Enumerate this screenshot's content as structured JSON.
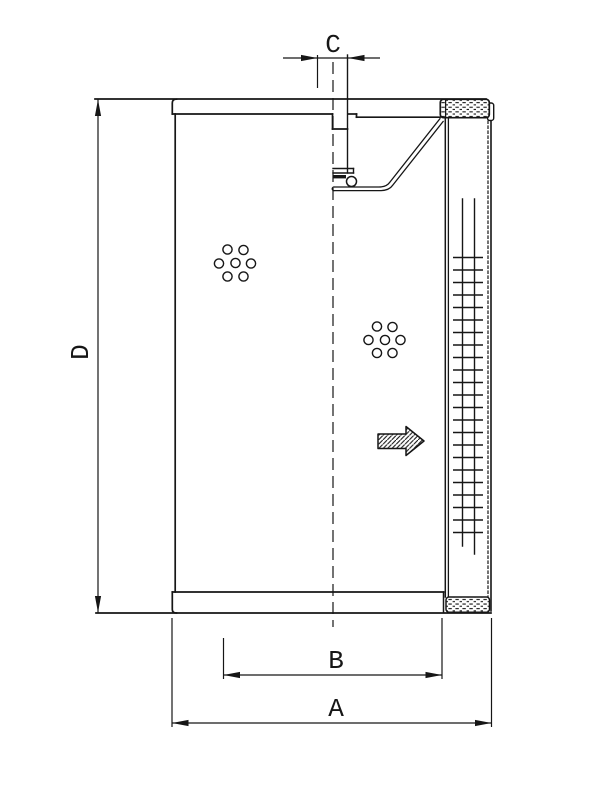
{
  "page": {
    "background": "#ffffff",
    "ink_color": "#161616",
    "kind": "technical line drawing",
    "subject": "filter element cross-section"
  },
  "drawing": {
    "labels": {
      "dim_c": "C",
      "dim_d": "D",
      "dim_b": "B",
      "dim_a": "A"
    },
    "dimensions": [
      {
        "id": "C",
        "label": "C",
        "orientation": "horizontal",
        "position": "top",
        "measures": "inner port diameter"
      },
      {
        "id": "D",
        "label": "D",
        "orientation": "vertical",
        "position": "left",
        "measures": "overall height"
      },
      {
        "id": "B",
        "label": "B",
        "orientation": "horizontal",
        "position": "bottom-inner",
        "measures": "inner diameter"
      },
      {
        "id": "A",
        "label": "A",
        "orientation": "horizontal",
        "position": "bottom-outer",
        "measures": "outer diameter"
      }
    ],
    "flow_arrow_direction": "right"
  }
}
